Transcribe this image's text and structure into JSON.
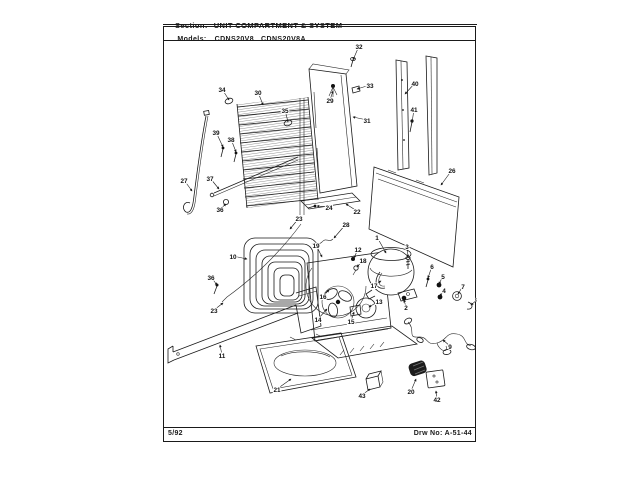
{
  "page": {
    "section_label": "Section:",
    "section_title": "UNIT COMPARTMENT & SYSTEM",
    "models_label": "Models:",
    "models_value": "CDNS20V8   CDNS20V8A",
    "footer_left": "5/92",
    "footer_right": "Drw No: A-51-44"
  },
  "colors": {
    "ink": "#1a1a1a",
    "paper": "#ffffff"
  },
  "diagram": {
    "type": "exploded-parts-diagram",
    "description": "Unit compartment and system exploded view with numbered part callouts",
    "callouts": [
      {
        "label": "32",
        "x": 359,
        "y": 48,
        "tx": 353,
        "ty": 60
      },
      {
        "label": "29",
        "x": 330,
        "y": 102,
        "tx": 333,
        "ty": 91
      },
      {
        "label": "33",
        "x": 370,
        "y": 87,
        "tx": 357,
        "ty": 89
      },
      {
        "label": "31",
        "x": 367,
        "y": 122,
        "tx": 353,
        "ty": 117
      },
      {
        "label": "40",
        "x": 415,
        "y": 85,
        "tx": 405,
        "ty": 94
      },
      {
        "label": "41",
        "x": 414,
        "y": 111,
        "tx": 412,
        "ty": 123
      },
      {
        "label": "34",
        "x": 222,
        "y": 91,
        "tx": 229,
        "ty": 100
      },
      {
        "label": "30",
        "x": 258,
        "y": 94,
        "tx": 263,
        "ty": 105
      },
      {
        "label": "35",
        "x": 285,
        "y": 112,
        "tx": 288,
        "ty": 122
      },
      {
        "label": "39",
        "x": 216,
        "y": 134,
        "tx": 223,
        "ty": 147
      },
      {
        "label": "38",
        "x": 231,
        "y": 141,
        "tx": 236,
        "ty": 152
      },
      {
        "label": "27",
        "x": 184,
        "y": 182,
        "tx": 192,
        "ty": 191
      },
      {
        "label": "37",
        "x": 210,
        "y": 180,
        "tx": 219,
        "ty": 189
      },
      {
        "label": "36",
        "x": 220,
        "y": 211,
        "tx": 226,
        "ty": 204
      },
      {
        "label": "26",
        "x": 452,
        "y": 172,
        "tx": 441,
        "ty": 185
      },
      {
        "label": "24",
        "x": 329,
        "y": 209,
        "tx": 317,
        "ty": 206
      },
      {
        "label": "23",
        "x": 299,
        "y": 220,
        "tx": 290,
        "ty": 229
      },
      {
        "label": "22",
        "x": 357,
        "y": 213,
        "tx": 346,
        "ty": 204
      },
      {
        "label": "28",
        "x": 346,
        "y": 226,
        "tx": 334,
        "ty": 238
      },
      {
        "label": "10",
        "x": 233,
        "y": 258,
        "tx": 247,
        "ty": 259
      },
      {
        "label": "1",
        "x": 377,
        "y": 239,
        "tx": 386,
        "ty": 253
      },
      {
        "label": "12",
        "x": 358,
        "y": 251,
        "tx": 354,
        "ty": 258
      },
      {
        "label": "18",
        "x": 363,
        "y": 262,
        "tx": 357,
        "ty": 267
      },
      {
        "label": "3",
        "x": 407,
        "y": 248,
        "tx": 408,
        "ty": 257
      },
      {
        "label": "19",
        "x": 316,
        "y": 247,
        "tx": 322,
        "ty": 257
      },
      {
        "label": "17",
        "x": 374,
        "y": 287,
        "tx": 381,
        "ty": 281
      },
      {
        "label": "16",
        "x": 323,
        "y": 298,
        "tx": 329,
        "ty": 290
      },
      {
        "label": "13",
        "x": 379,
        "y": 303,
        "tx": 369,
        "ty": 307
      },
      {
        "label": "14",
        "x": 318,
        "y": 321,
        "tx": 327,
        "ty": 309
      },
      {
        "label": "15",
        "x": 351,
        "y": 323,
        "tx": 354,
        "ty": 312
      },
      {
        "label": "6",
        "x": 432,
        "y": 268,
        "tx": 428,
        "ty": 278
      },
      {
        "label": "5",
        "x": 443,
        "y": 278,
        "tx": 439,
        "ty": 284
      },
      {
        "label": "4",
        "x": 444,
        "y": 292,
        "tx": 440,
        "ty": 296
      },
      {
        "label": "7",
        "x": 463,
        "y": 288,
        "tx": 458,
        "ty": 294
      },
      {
        "label": "8",
        "x": 478,
        "y": 301,
        "tx": 471,
        "ty": 305
      },
      {
        "label": "2",
        "x": 406,
        "y": 309,
        "tx": 404,
        "ty": 300
      },
      {
        "label": "36",
        "x": 211,
        "y": 279,
        "tx": 217,
        "ty": 285
      },
      {
        "label": "23",
        "x": 214,
        "y": 312,
        "tx": 223,
        "ty": 303
      },
      {
        "label": "11",
        "x": 222,
        "y": 357,
        "tx": 220,
        "ty": 345
      },
      {
        "label": "21",
        "x": 277,
        "y": 391,
        "tx": 291,
        "ty": 379
      },
      {
        "label": "9",
        "x": 450,
        "y": 348,
        "tx": 443,
        "ty": 340
      },
      {
        "label": "43",
        "x": 362,
        "y": 397,
        "tx": 370,
        "ty": 389
      },
      {
        "label": "20",
        "x": 411,
        "y": 393,
        "tx": 416,
        "ty": 379
      },
      {
        "label": "42",
        "x": 437,
        "y": 401,
        "tx": 436,
        "ty": 391
      }
    ]
  }
}
